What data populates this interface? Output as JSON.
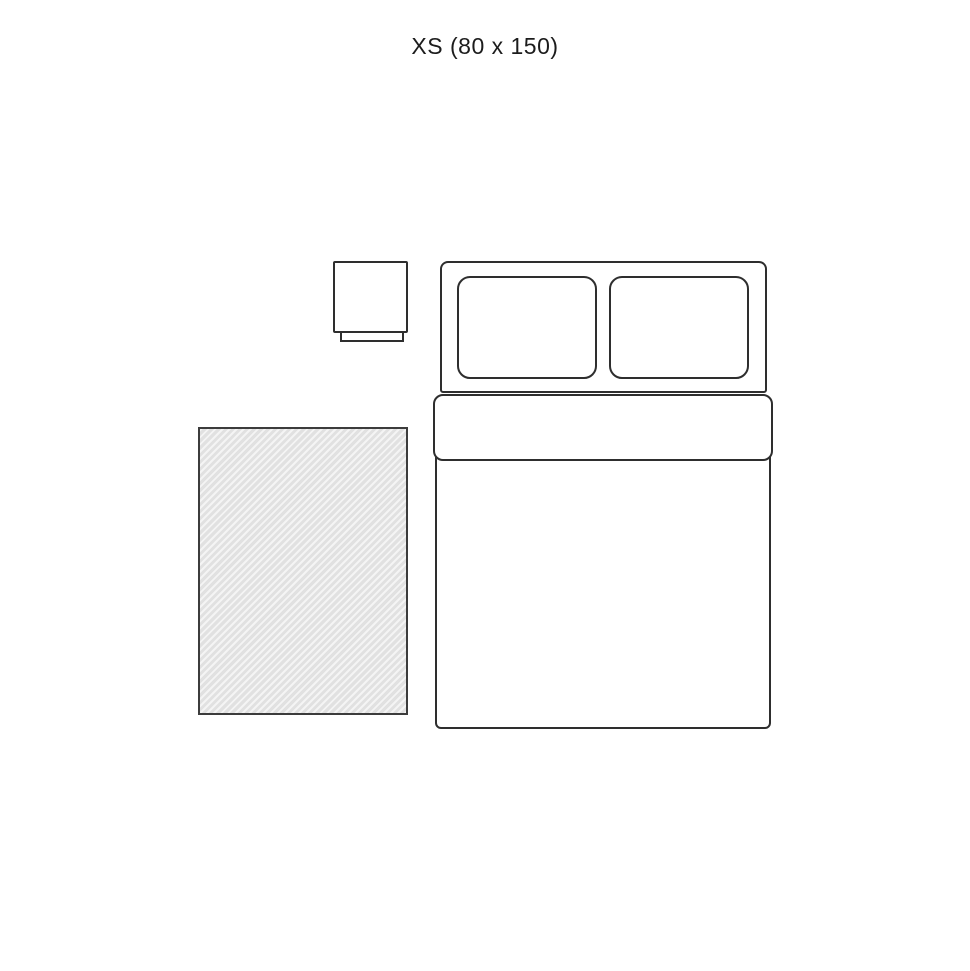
{
  "diagram": {
    "title": "XS (80 x 150)",
    "size_code": "XS",
    "dimensions": "80 x 150",
    "items": [
      "rug",
      "bed",
      "pillow-left",
      "pillow-right",
      "nightstand"
    ]
  },
  "colors": {
    "background": "#ffffff",
    "line": "#2e2e2e",
    "rug_border": "#3c3c3c",
    "rug_fill_light": "#f4f4f4",
    "rug_fill_dark": "#e1e1e1",
    "title_text": "#1c1c1c"
  }
}
